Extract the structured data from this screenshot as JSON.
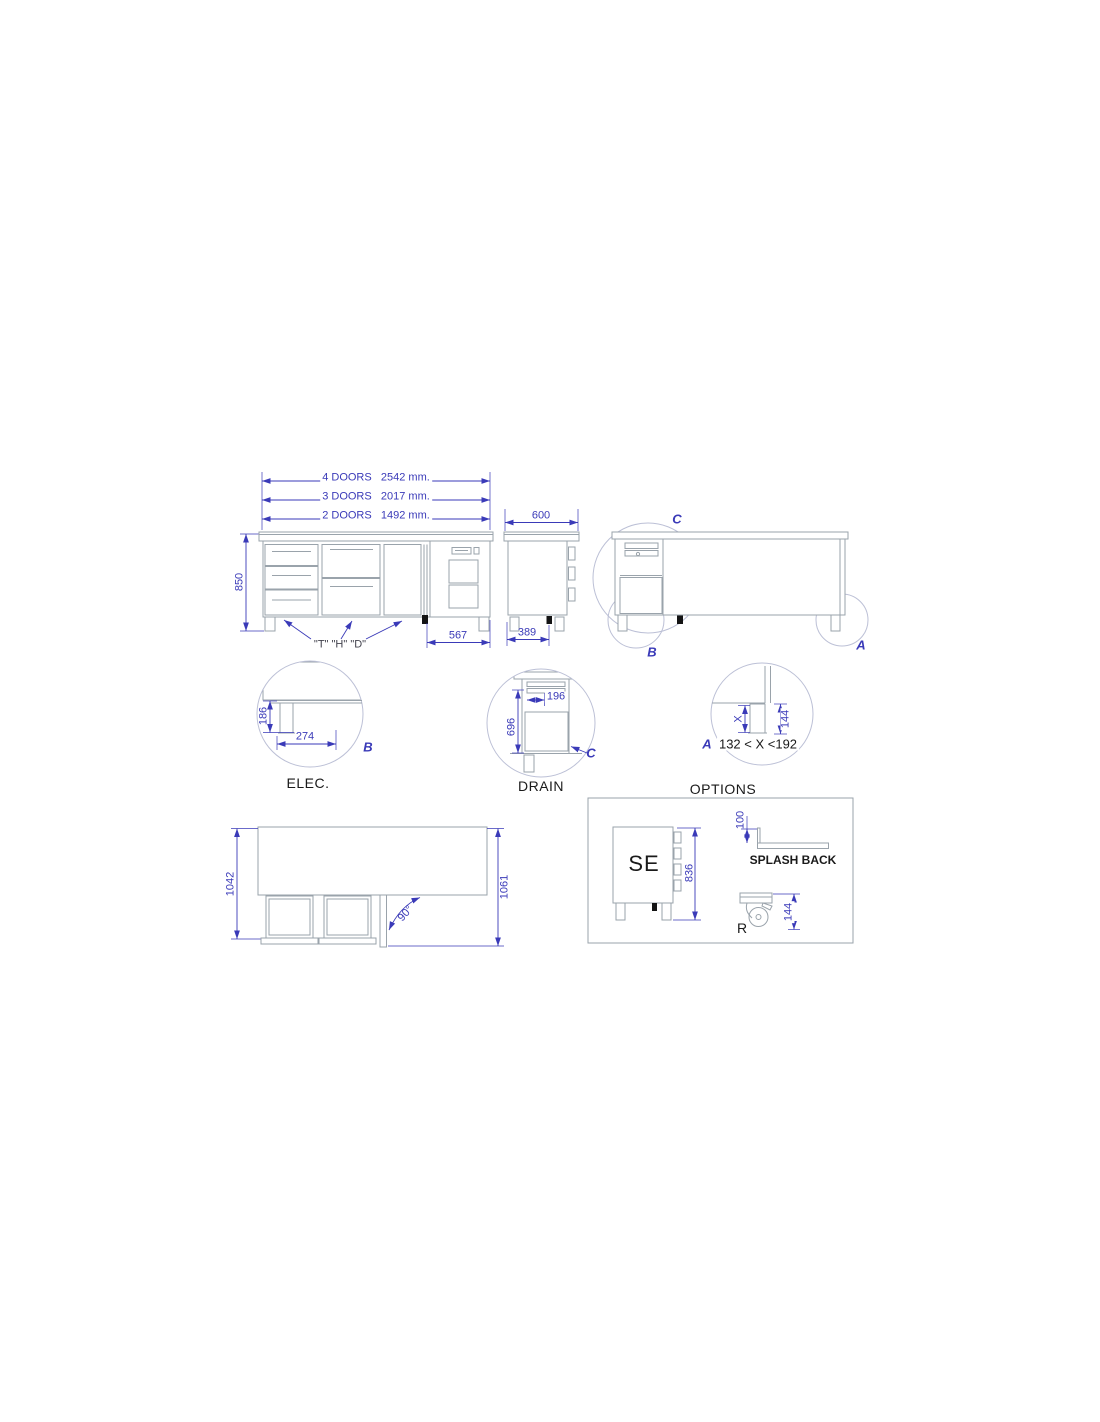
{
  "front_view": {
    "dim_4_doors": "4 DOORS   2542 mm.",
    "dim_3_doors": "3 DOORS   2017 mm.",
    "dim_2_doors": "2 DOORS   1492 mm.",
    "dim_height": "850",
    "dim_compressor": "567",
    "section_labels": "\"T\" \"H\" \"D\""
  },
  "side_view": {
    "dim_depth": "600",
    "dim_legs": "389"
  },
  "rear_view": {
    "label_c": "C",
    "label_b": "B",
    "label_a": "A"
  },
  "elec_detail": {
    "dim_height": "186",
    "dim_width": "274",
    "label": "B",
    "caption": "ELEC."
  },
  "drain_detail": {
    "dim_width": "196",
    "dim_height": "696",
    "label": "C",
    "caption": "DRAIN"
  },
  "leg_detail": {
    "dim_x": "X",
    "dim_144": "144",
    "range": "132 < X <192",
    "label": "A"
  },
  "top_view": {
    "dim_closed": "1042",
    "dim_open": "1061",
    "dim_angle": "90°"
  },
  "options": {
    "title": "OPTIONS",
    "se_label": "SE",
    "dim_se_height": "836",
    "dim_splash": "100",
    "splash_caption": "SPLASH BACK",
    "caster_label": "R",
    "dim_caster": "144"
  },
  "colors": {
    "dimension_blue": "#3a3ab8",
    "object_gray": "#9aa3ab",
    "text_black": "#1a1a1a"
  }
}
